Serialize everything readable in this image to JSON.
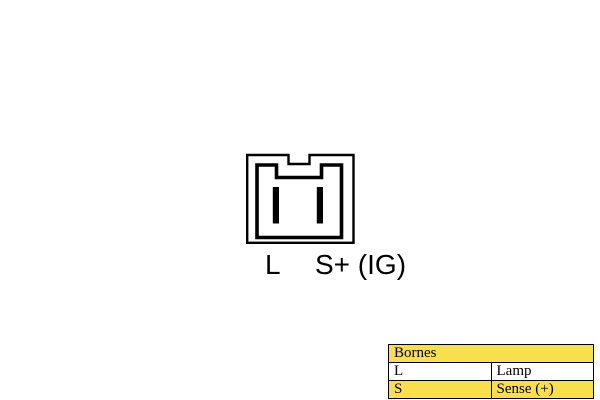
{
  "diagram": {
    "name": "two-pin-connector-pinout",
    "pin_labels": {
      "left": "L",
      "right": "S+ (IG)"
    },
    "line_color": "#000000"
  },
  "legend_table": {
    "header": "Bornes",
    "rows": [
      {
        "code": "L",
        "label": "Lamp"
      },
      {
        "code": "S",
        "label": "Sense (+)"
      }
    ],
    "highlight_color": "#f7df4e",
    "row_color": "#ffffff",
    "border_color": "#000000"
  },
  "canvas": {
    "background": "#ffffff"
  }
}
